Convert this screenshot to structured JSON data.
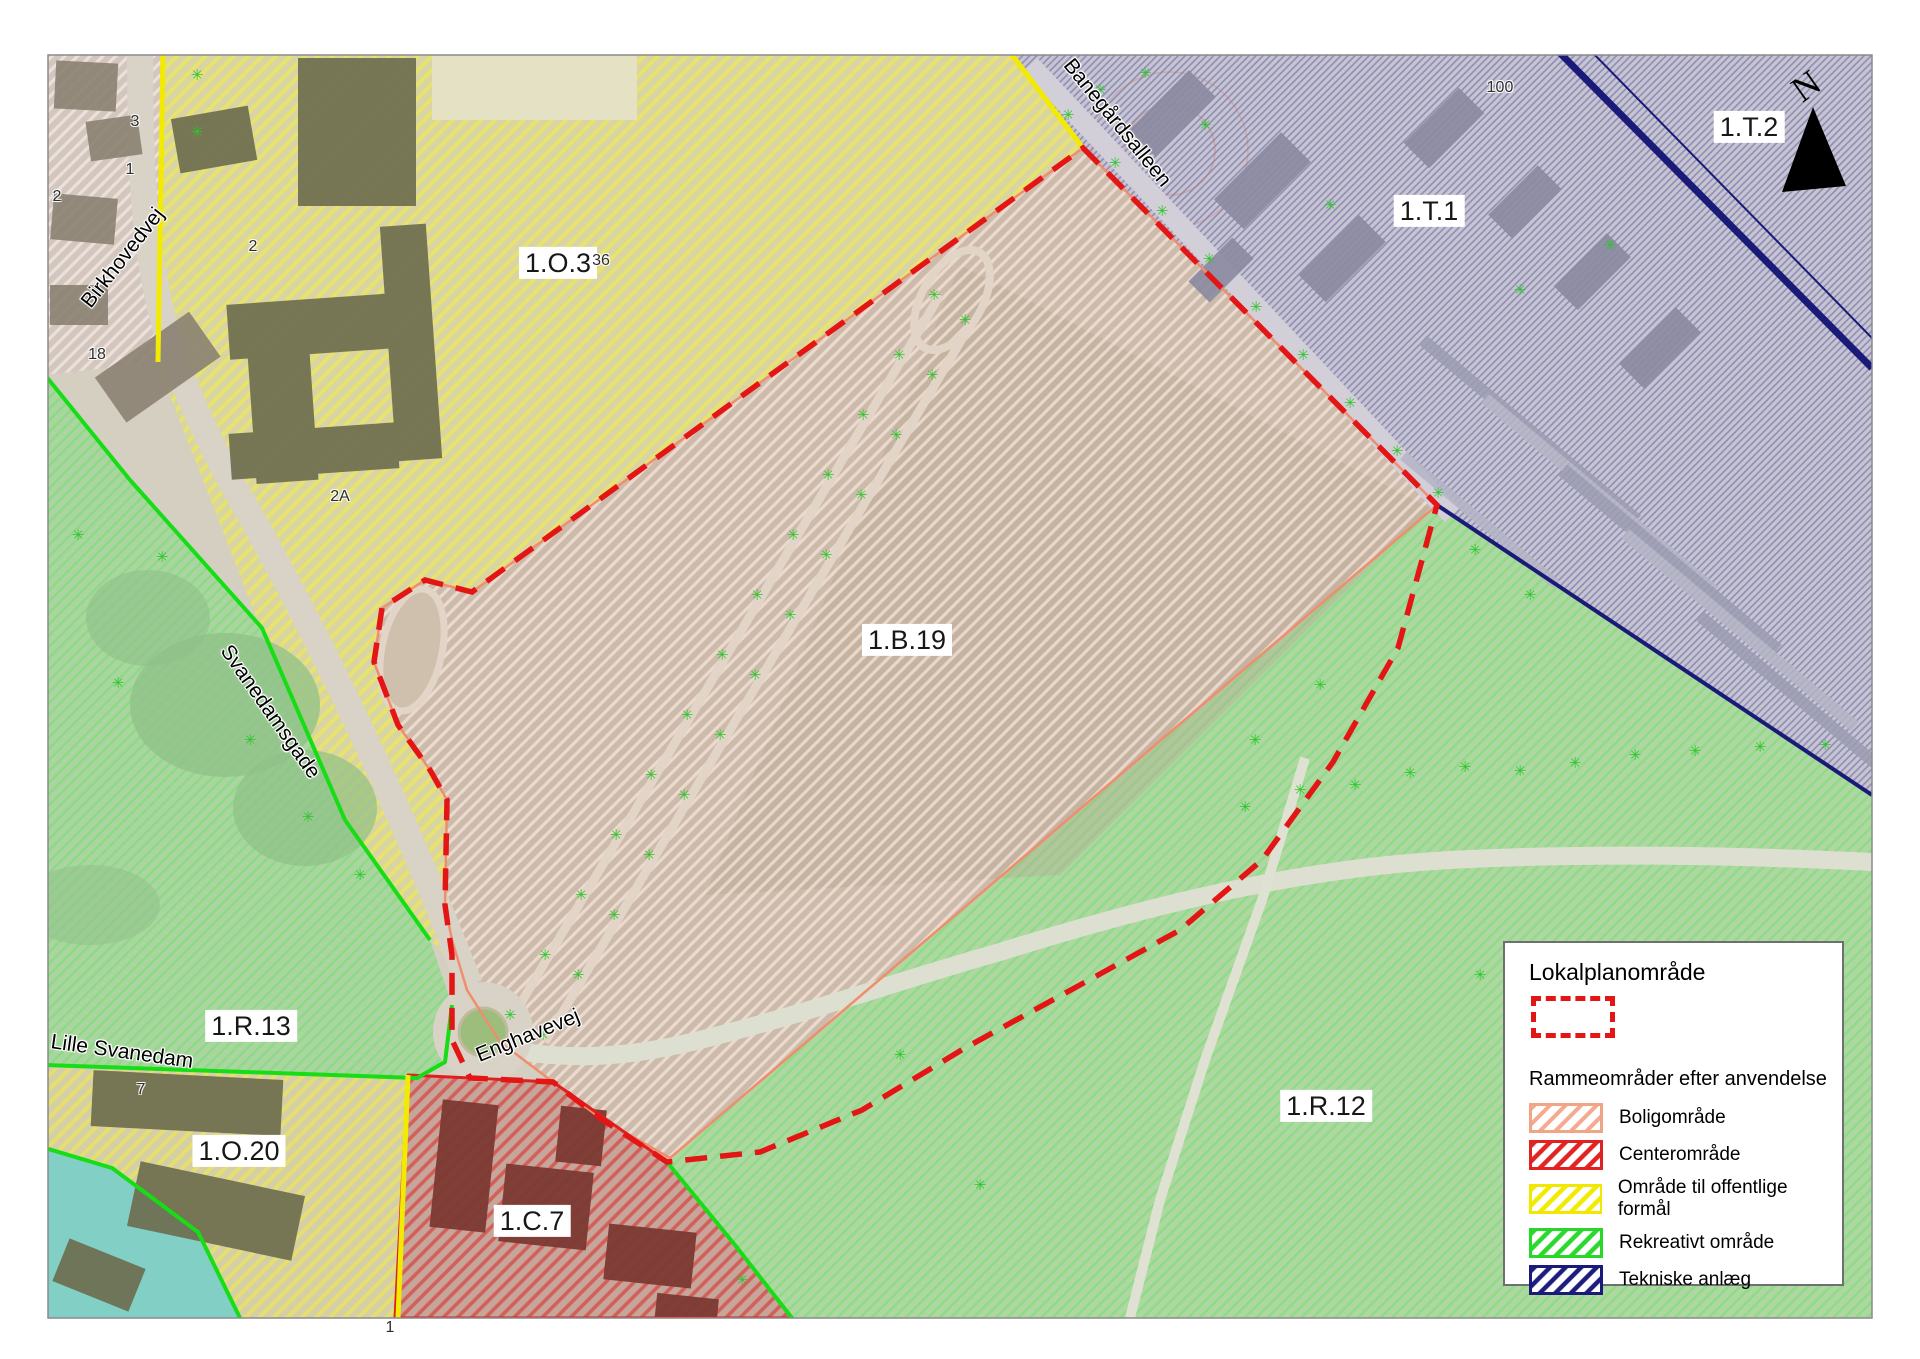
{
  "map": {
    "north_label": "N",
    "tree_symbol": "✳",
    "zone_labels": [
      {
        "text": "1.O.3",
        "x": 558,
        "y": 263
      },
      {
        "text": "1.T.1",
        "x": 1429,
        "y": 211
      },
      {
        "text": "1.T.2",
        "x": 1749,
        "y": 127
      },
      {
        "text": "1.B.19",
        "x": 907,
        "y": 640
      },
      {
        "text": "1.R.13",
        "x": 251,
        "y": 1026
      },
      {
        "text": "1.R.12",
        "x": 1326,
        "y": 1106
      },
      {
        "text": "1.O.20",
        "x": 239,
        "y": 1151
      },
      {
        "text": "1.C.7",
        "x": 532,
        "y": 1221
      }
    ],
    "street_labels": [
      {
        "text": "Birkhovedvej",
        "x": 123,
        "y": 258,
        "rot": -52
      },
      {
        "text": "Svanedamsgade",
        "x": 270,
        "y": 712,
        "rot": 55
      },
      {
        "text": "Banegårdsalleen",
        "x": 1117,
        "y": 123,
        "rot": 51
      },
      {
        "text": "Enghavevej",
        "x": 528,
        "y": 1036,
        "rot": -22
      },
      {
        "text": "Lille Svanedam",
        "x": 122,
        "y": 1052,
        "rot": 8
      }
    ],
    "house_numbers": [
      {
        "text": "3",
        "x": 135,
        "y": 122
      },
      {
        "text": "1",
        "x": 130,
        "y": 170
      },
      {
        "text": "2",
        "x": 57,
        "y": 197
      },
      {
        "text": "2",
        "x": 253,
        "y": 247
      },
      {
        "text": "18",
        "x": 97,
        "y": 355
      },
      {
        "text": "2A",
        "x": 340,
        "y": 497
      },
      {
        "text": "36",
        "x": 601,
        "y": 261
      },
      {
        "text": "7",
        "x": 141,
        "y": 1090
      },
      {
        "text": "100",
        "x": 1500,
        "y": 88
      },
      {
        "text": "1",
        "x": 390,
        "y": 1328
      }
    ],
    "trees": [
      [
        510,
        1020
      ],
      [
        545,
        960
      ],
      [
        581,
        900
      ],
      [
        616,
        840
      ],
      [
        651,
        780
      ],
      [
        687,
        720
      ],
      [
        722,
        660
      ],
      [
        757,
        600
      ],
      [
        793,
        540
      ],
      [
        828,
        480
      ],
      [
        863,
        420
      ],
      [
        899,
        360
      ],
      [
        934,
        300
      ],
      [
        543,
        1040
      ],
      [
        578,
        980
      ],
      [
        614,
        920
      ],
      [
        649,
        860
      ],
      [
        684,
        800
      ],
      [
        720,
        740
      ],
      [
        755,
        680
      ],
      [
        790,
        620
      ],
      [
        826,
        560
      ],
      [
        861,
        500
      ],
      [
        896,
        440
      ],
      [
        932,
        380
      ],
      [
        965,
        325
      ],
      [
        1068,
        120
      ],
      [
        1115,
        168
      ],
      [
        1162,
        216
      ],
      [
        1209,
        264
      ],
      [
        1256,
        312
      ],
      [
        1303,
        360
      ],
      [
        1350,
        408
      ],
      [
        1397,
        456
      ],
      [
        1438,
        498
      ],
      [
        1100,
        95
      ],
      [
        1145,
        78
      ],
      [
        1205,
        130
      ],
      [
        1330,
        210
      ],
      [
        1520,
        295
      ],
      [
        1610,
        250
      ],
      [
        1245,
        812
      ],
      [
        1300,
        795
      ],
      [
        1355,
        790
      ],
      [
        1410,
        778
      ],
      [
        1465,
        772
      ],
      [
        1520,
        776
      ],
      [
        1575,
        768
      ],
      [
        1635,
        760
      ],
      [
        1695,
        756
      ],
      [
        1760,
        752
      ],
      [
        1825,
        750
      ],
      [
        1475,
        555
      ],
      [
        1530,
        600
      ],
      [
        1320,
        690
      ],
      [
        1255,
        745
      ],
      [
        980,
        1190
      ],
      [
        1480,
        980
      ],
      [
        1660,
        1120
      ],
      [
        900,
        1060
      ],
      [
        78,
        540
      ],
      [
        162,
        562
      ],
      [
        118,
        688
      ],
      [
        250,
        745
      ],
      [
        308,
        822
      ],
      [
        360,
        880
      ],
      [
        197,
        80
      ],
      [
        197,
        137
      ],
      [
        742,
        1285
      ]
    ]
  },
  "legend": {
    "title": "Lokalplanområde",
    "subtitle": "Rammeområder efter anvendelse",
    "items": [
      {
        "label": "Boligområde",
        "stripe": "#f5a98f",
        "border": "#f0a488"
      },
      {
        "label": "Centerområde",
        "stripe": "#e02424",
        "border": "#e02222"
      },
      {
        "label": "Område til offentlige formål",
        "stripe": "#f2ea00",
        "border": "#f0e800"
      },
      {
        "label": "Rekreativt område",
        "stripe": "#2bd82b",
        "border": "#28d828"
      },
      {
        "label": "Tekniske anlæg",
        "stripe": "#1d1d80",
        "border": "#1a1a78"
      }
    ],
    "colors": {
      "lokalplan_dash": "#e31515",
      "zone_border_green": "#17dd17",
      "zone_border_yellow": "#f2ea00",
      "zone_border_navy": "#1a1a78",
      "zone_border_salmon": "#ef8e6e",
      "zone_border_red": "#e02020",
      "water": "#82cfc6"
    }
  }
}
